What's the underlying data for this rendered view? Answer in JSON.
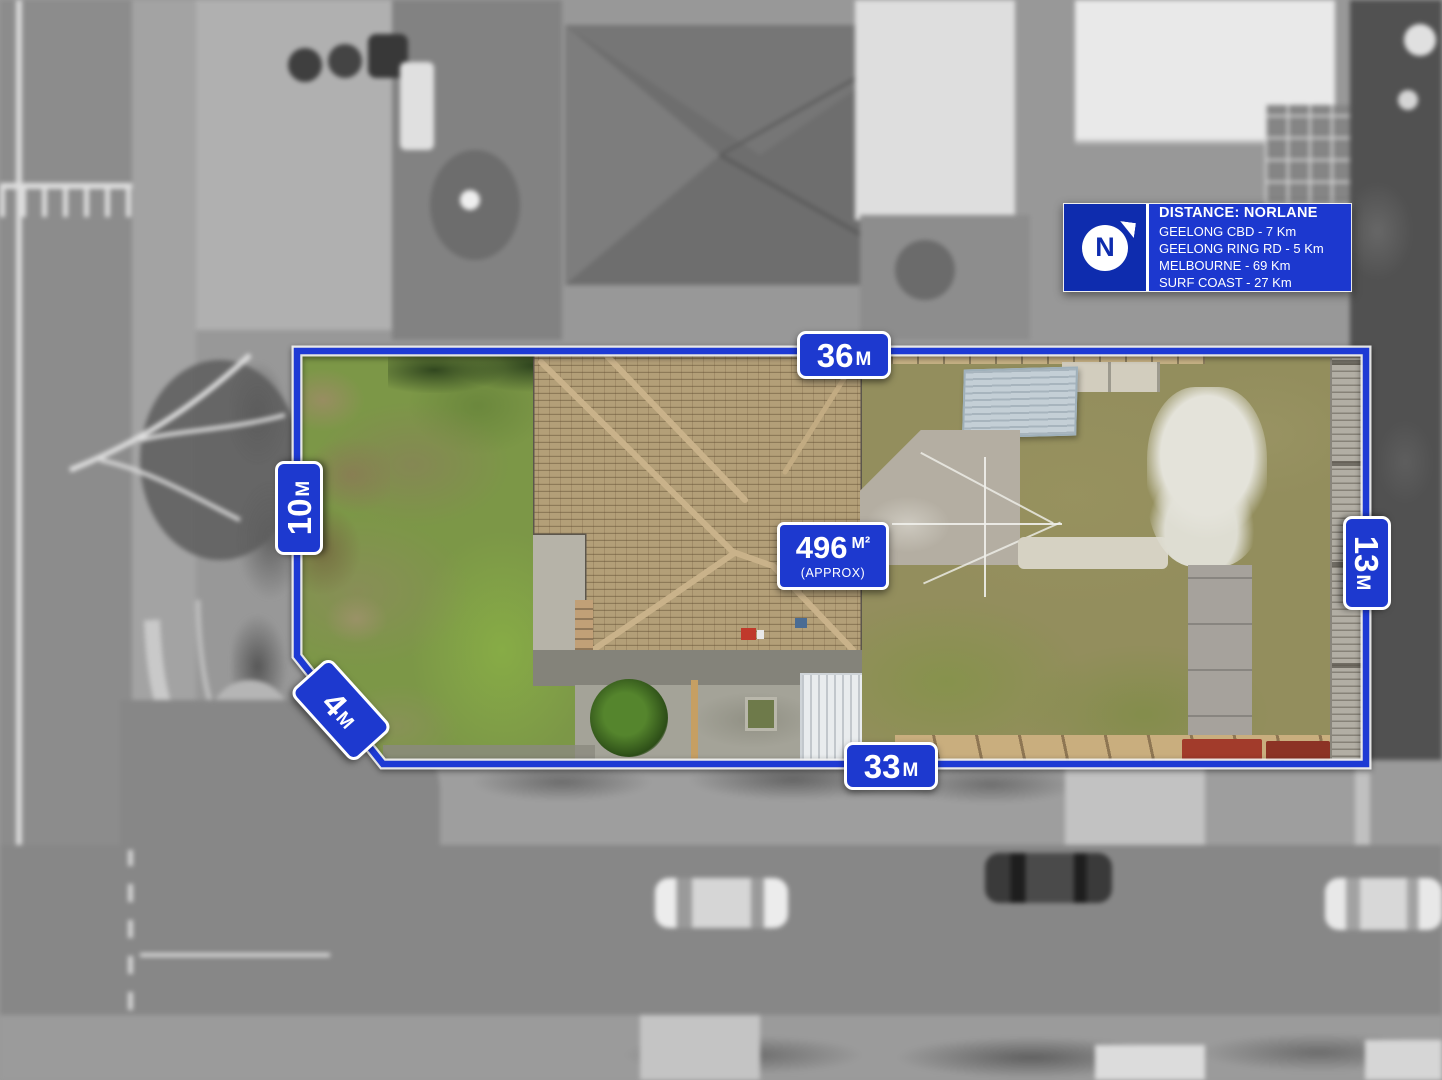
{
  "info_box": {
    "logo_letter": "N",
    "title": "DISTANCE: NORLANE",
    "lines": [
      "GEELONG CBD - 7 Km",
      "GEELONG RING RD - 5 Km",
      "MELBOURNE - 69 Km",
      "SURF COAST - 27 Km"
    ]
  },
  "dimensions": {
    "top": {
      "value": "36",
      "unit": "M"
    },
    "left": {
      "value": "10",
      "unit": "M"
    },
    "corner": {
      "value": "4",
      "unit": "M"
    },
    "bottom": {
      "value": "33",
      "unit": "M"
    },
    "right": {
      "value": "13",
      "unit": "M"
    }
  },
  "area": {
    "value": "496",
    "unit": "M²",
    "qualifier": "(APPROX)"
  },
  "colors": {
    "brand_blue": "#1c38cf",
    "logo_blue": "#0e2cae",
    "boundary_blue": "#1e3ad4",
    "label_text": "#ffffff"
  }
}
